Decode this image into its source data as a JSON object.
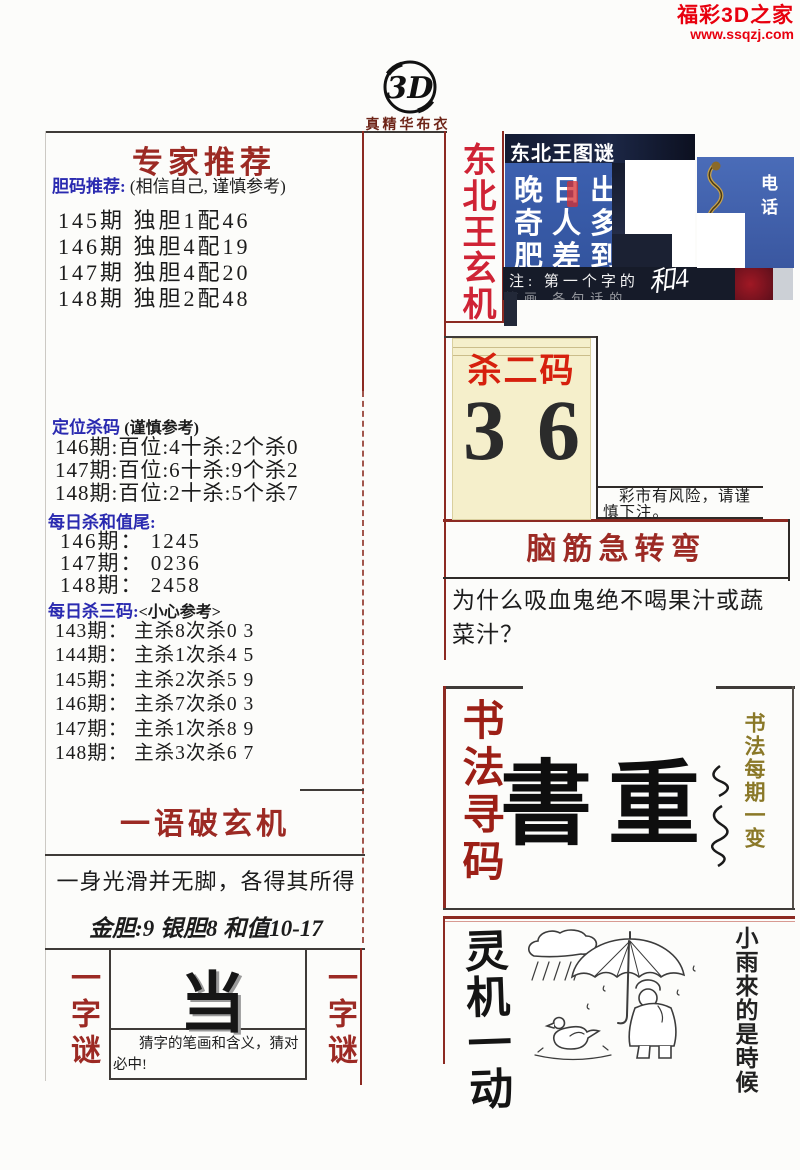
{
  "brand": {
    "name": "福彩3D之家",
    "url": "www.ssqzj.com"
  },
  "masthead": {
    "logo_text": "3D",
    "subtitle": "真精华布衣"
  },
  "colors": {
    "brand_red": "#e8000e",
    "title_red": "#9c2a24",
    "crimson": "#cf2335",
    "label_blue": "#2a2ab0",
    "panel_blue": "#3a5db0",
    "cream": "#f5efcb",
    "olive": "#8a7828"
  },
  "left": {
    "expert": {
      "title": "专家推荐",
      "label": "胆码推荐:",
      "note": "(相信自己, 谨慎参考)",
      "lines": [
        "145期 独胆1配46",
        "146期 独胆4配19",
        "147期 独胆4配20",
        "148期 独胆2配48"
      ]
    },
    "dingwei": {
      "label": "定位杀码",
      "note": "(谨慎参考)",
      "lines": [
        "146期:百位:4十杀:2个杀0",
        "147期:百位:6十杀:9个杀2",
        "148期:百位:2十杀:5个杀7"
      ]
    },
    "hezhiwei": {
      "label": "每日杀和值尾:",
      "lines": [
        "146期： 1245",
        "147期： 0236",
        "148期： 2458"
      ]
    },
    "sansanma": {
      "label": "每日杀三码:",
      "note": "<小心参考>",
      "lines": [
        "143期： 主杀8次杀0 3",
        "144期： 主杀1次杀4 5",
        "145期： 主杀2次杀5 9",
        "146期： 主杀7次杀0 3",
        "147期： 主杀1次杀8 9",
        "148期： 主杀3次杀6 7"
      ]
    },
    "yuyu": {
      "title": "一语破玄机",
      "riddle": "一身光滑并无脚，各得其所得",
      "golden": "金胆:9 银胆8 和值10-17"
    },
    "yizimi": {
      "side_label": "一字谜",
      "char": "当",
      "hint": "猜字的笔画和含义，猜对必中!"
    }
  },
  "right": {
    "dongbei": {
      "side_label": "东北王玄机",
      "panel_title": "东北王图谜",
      "rows": [
        "晚日出",
        "奇人多",
        "肥差到"
      ],
      "phone_label": "电话",
      "note_line1": "注: 第一个字的",
      "note_line2": "笔画 各句话的",
      "scribble": "和4"
    },
    "shaerma": {
      "title": "杀二码",
      "num1": "3",
      "num2": "6",
      "risk_note": "彩市有风险，请谨慎下注。"
    },
    "naojin": {
      "title": "脑筋急转弯",
      "question": "为什么吸血鬼绝不喝果汁或蔬菜汁？"
    },
    "shufa": {
      "side_label": "书法寻码",
      "calligraphy": "書重",
      "right_label": "书法每期一变"
    },
    "lingji": {
      "side_label": "灵机一动",
      "right_label": "小雨來的是時候"
    }
  }
}
